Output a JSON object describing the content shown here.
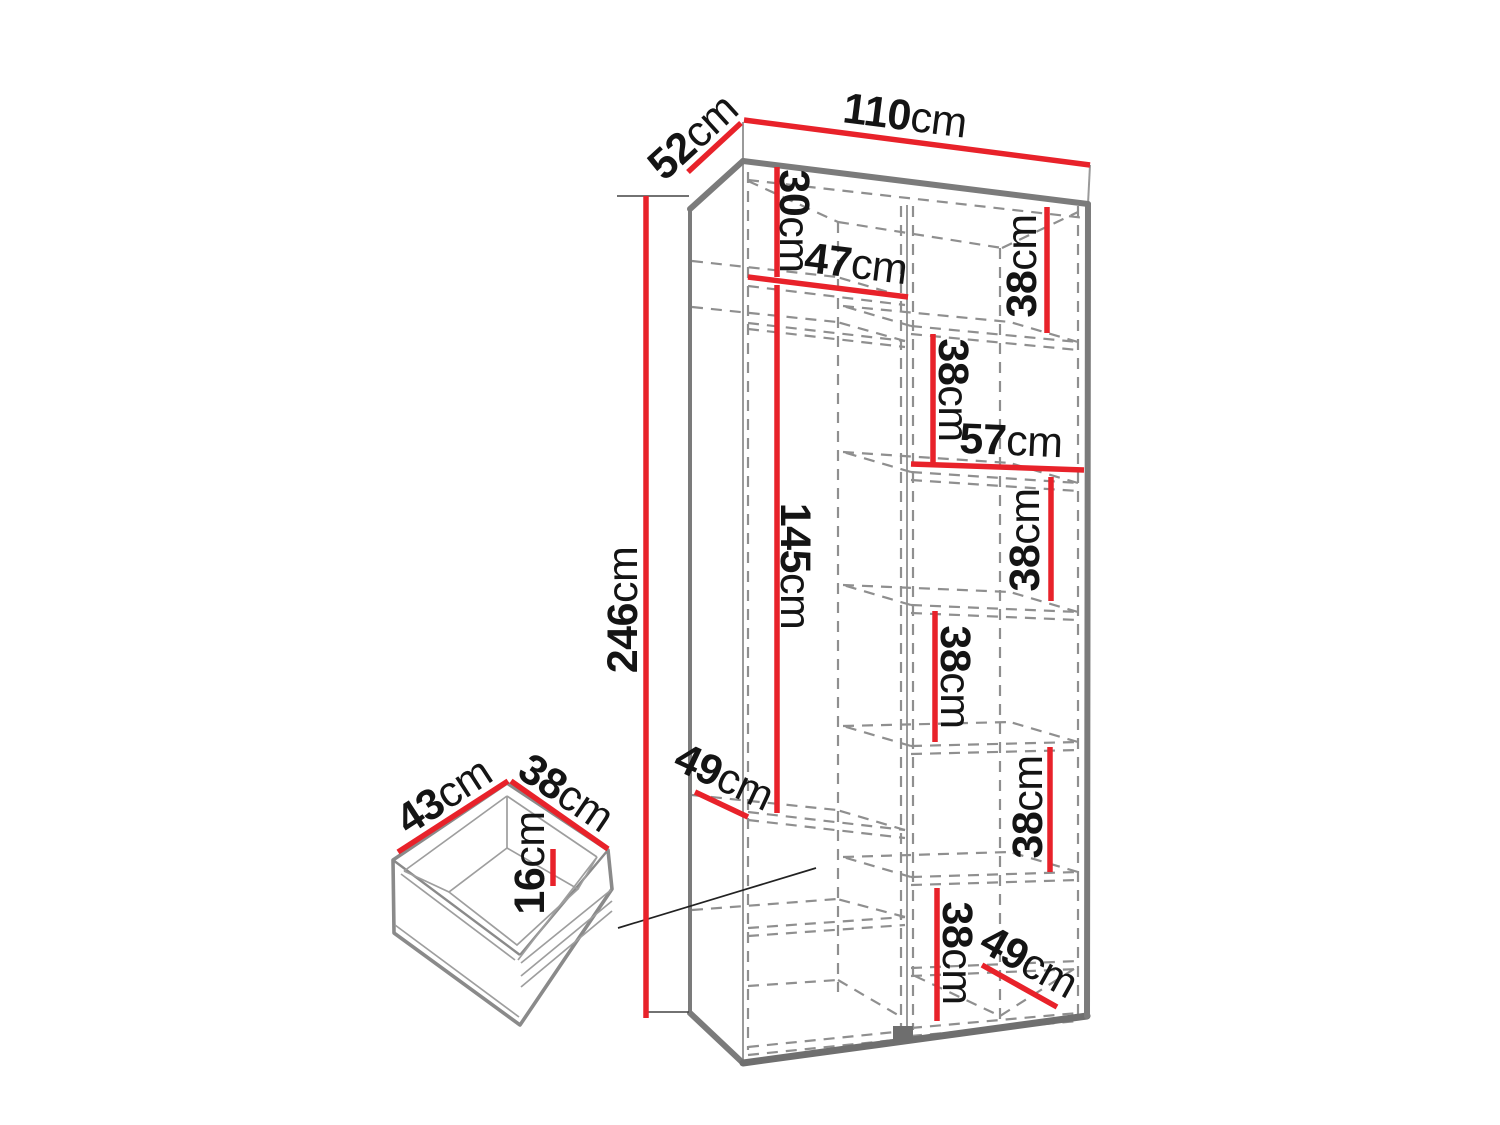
{
  "diagram": {
    "kind": "furniture-dimension-diagram",
    "subject": "wardrobe interior dimensions with pull-out drawer detail"
  },
  "colors": {
    "dimension_line_red": "#e8222a",
    "outline_gray": "#7b7b7b",
    "dashed_gray": "#8f8f8f",
    "label_black": "#141414",
    "background": "#ffffff"
  },
  "wardrobe": {
    "width": {
      "value": "110",
      "unit": "cm"
    },
    "depth": {
      "value": "52",
      "unit": "cm"
    },
    "height": {
      "value": "246",
      "unit": "cm"
    },
    "top_compartment_height": {
      "value": "30",
      "unit": "cm"
    },
    "left_section_width": {
      "value": "47",
      "unit": "cm"
    },
    "right_shelf_1_height": {
      "value": "38",
      "unit": "cm"
    },
    "right_shelf_2_height": {
      "value": "38",
      "unit": "cm"
    },
    "right_section_width": {
      "value": "57",
      "unit": "cm"
    },
    "hanging_space_height": {
      "value": "145",
      "unit": "cm"
    },
    "right_shelf_3_height": {
      "value": "38",
      "unit": "cm"
    },
    "right_shelf_4_height": {
      "value": "38",
      "unit": "cm"
    },
    "left_bottom_shelf_depth": {
      "value": "49",
      "unit": "cm"
    },
    "right_shelf_5_height": {
      "value": "38",
      "unit": "cm"
    },
    "right_shelf_6_height": {
      "value": "38",
      "unit": "cm"
    },
    "right_bottom_shelf_depth": {
      "value": "49",
      "unit": "cm"
    }
  },
  "drawer": {
    "width": {
      "value": "43",
      "unit": "cm"
    },
    "depth": {
      "value": "38",
      "unit": "cm"
    },
    "height": {
      "value": "16",
      "unit": "cm"
    }
  }
}
